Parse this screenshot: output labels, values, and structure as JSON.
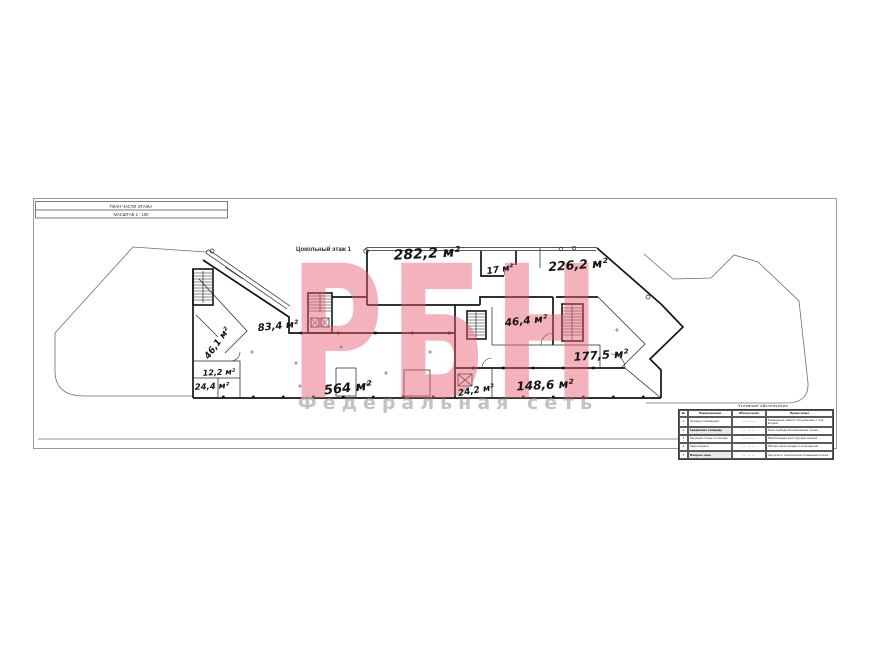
{
  "document": {
    "title_block": {
      "line1": "ПЛАН ЧАСТИ ЭТАЖА",
      "line2": "МАСШТАБ 1 : 100"
    },
    "floor_label": "Цокольный этаж 1"
  },
  "rooms": {
    "r282": "282,2 м²",
    "r17": "17 м²",
    "r226": "226,2 м²",
    "r83": "83,4 м²",
    "r46_1": "46,1 м²",
    "r46_4": "46,4 м²",
    "r177": "177,5 м²",
    "r12": "12,2 м²",
    "r24_4": "24,4 м²",
    "r564": "564 м²",
    "r24_2": "24,2 м²",
    "r148": "148,6 м²"
  },
  "watermark": {
    "brand": "РБН",
    "subtitle": "Федеральная сеть",
    "brand_color": "#e75d73",
    "subtitle_color": "#b5b5b5"
  },
  "legend": {
    "title": "Условные обозначения",
    "headers": {
      "n": "№",
      "name": "Наименование",
      "mark": "Обозначение",
      "note": "Примечание"
    },
    "rows": [
      {
        "n": "1",
        "name": "Граница помещения",
        "mark": "————",
        "note": "Помещение общего пользования с отд. входом"
      },
      {
        "n": "2",
        "name": "Сдаваемая площадь",
        "mark": "— — —",
        "note": "Зона свободной планировки этажа"
      },
      {
        "n": "3",
        "name": "Несущие стены и колонны",
        "mark": "————",
        "note": "Капитальные конструкции здания"
      },
      {
        "n": "4",
        "name": "Перегородки",
        "mark": "— — —",
        "note": "Лёгкие перегородки и ограждения"
      },
      {
        "n": "5",
        "name": "Мокрые зоны",
        "mark": "— — —",
        "note": "Санузлы и технические помещения этажа"
      }
    ]
  }
}
